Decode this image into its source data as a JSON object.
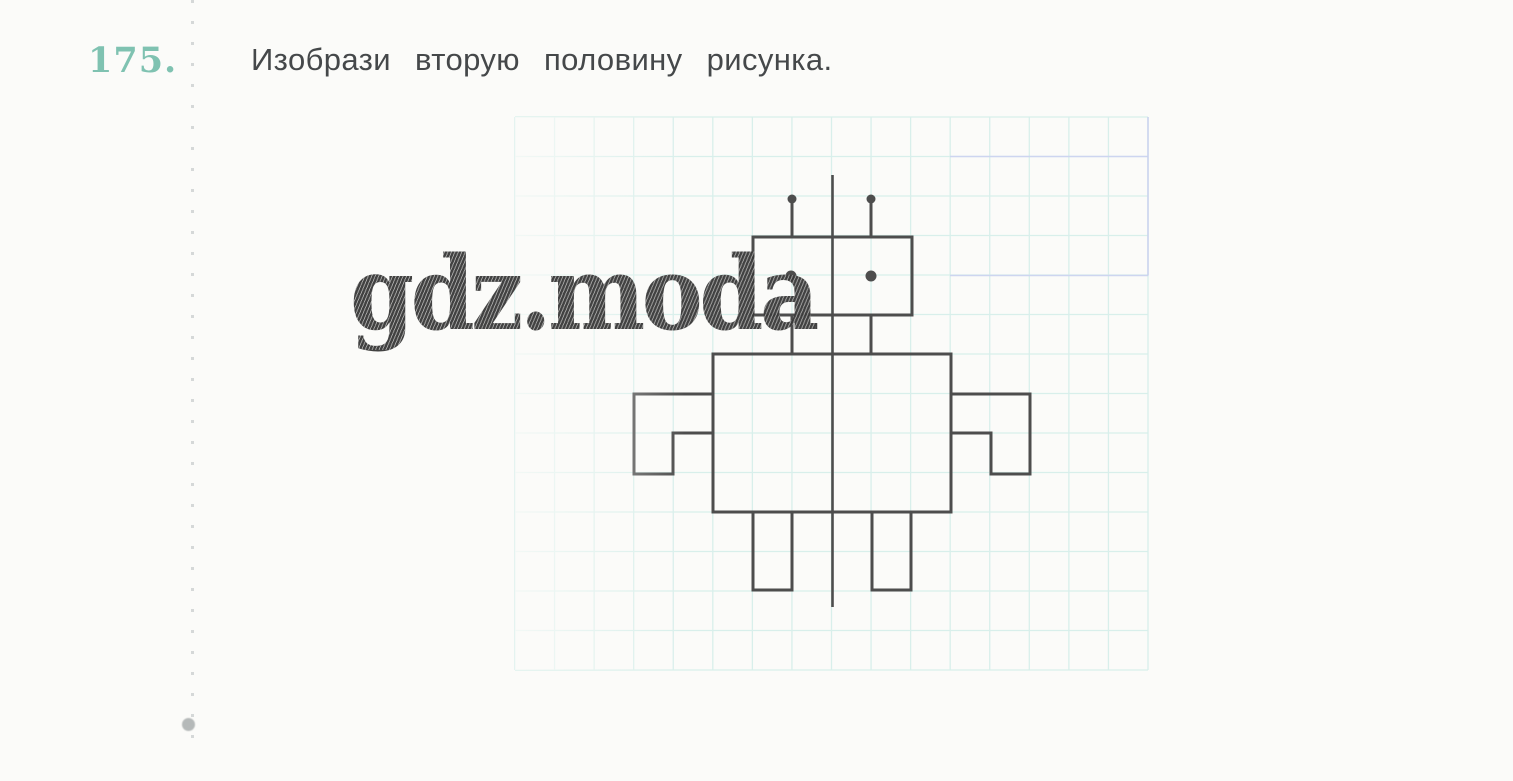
{
  "page": {
    "background": "#fbfbf9"
  },
  "task": {
    "number": "175.",
    "number_color": "#7fc2b1",
    "instruction": "Изобрази  вторую  половину  рисунка.",
    "instruction_color": "#45484a"
  },
  "watermark": {
    "text": "gdz.moda",
    "color": "#3a3a3a"
  },
  "margin": {
    "dots_color": "#ced2d2",
    "blob_color": "#b5b9b9"
  },
  "figure": {
    "description": "half of a robot drawn on squared paper, to be mirrored across the vertical axis",
    "stroke_color": "#4d4d4d",
    "stroke_width": 3,
    "grid": {
      "x": 515,
      "y": 117,
      "cols": 16,
      "rows": 14,
      "cell_w": 39.5625,
      "cell_h": 39.5,
      "line_color": "#d8efeb",
      "line_width": 1.3
    },
    "accent_lines": [
      {
        "x1": 950,
        "y1": 156.5,
        "x2": 1148,
        "y2": 156.5,
        "color": "#cdd5f0"
      },
      {
        "x1": 950,
        "y1": 275.5,
        "x2": 1148,
        "y2": 275.5,
        "color": "#cdd5f0"
      },
      {
        "x1": 1148,
        "y1": 117,
        "x2": 1148,
        "y2": 275.5,
        "color": "#c9d2ee"
      }
    ],
    "axis": {
      "name": "symmetry-axis-line",
      "x1": 832.5,
      "y1": 175,
      "x2": 832.5,
      "y2": 607,
      "width": 2.6
    },
    "rects": [
      {
        "name": "robot-head",
        "x": 753,
        "y": 237,
        "w": 159,
        "h": 78
      },
      {
        "name": "robot-body",
        "x": 713,
        "y": 354,
        "w": 238,
        "h": 158
      }
    ],
    "lines": [
      {
        "name": "robot-neck-left",
        "x1": 792,
        "y1": 315,
        "x2": 792,
        "y2": 354
      },
      {
        "name": "robot-neck-right",
        "x1": 871,
        "y1": 315,
        "x2": 871,
        "y2": 354
      },
      {
        "name": "robot-antenna-left",
        "x1": 792,
        "y1": 202,
        "x2": 792,
        "y2": 237
      },
      {
        "name": "robot-antenna-right",
        "x1": 871,
        "y1": 202,
        "x2": 871,
        "y2": 237
      }
    ],
    "polylines": [
      {
        "name": "robot-arm-left",
        "points": "713,394 634,394 634,474 673,474 673,433 713,433"
      },
      {
        "name": "robot-arm-right",
        "points": "951,394 1030,394 1030,474 991,474 991,433 951,433"
      },
      {
        "name": "robot-leg-left",
        "points": "753,512 753,590 792,590 792,512"
      },
      {
        "name": "robot-leg-right",
        "points": "872,512 872,590 911,590 911,512"
      }
    ],
    "dots": [
      {
        "name": "robot-antenna-tip-left",
        "x": 792,
        "y": 199,
        "r": 4.5
      },
      {
        "name": "robot-antenna-tip-right",
        "x": 871,
        "y": 199,
        "r": 4.5
      },
      {
        "name": "robot-eye-left",
        "x": 791,
        "y": 276,
        "r": 5.5
      },
      {
        "name": "robot-eye-right",
        "x": 871,
        "y": 276,
        "r": 5.5
      }
    ]
  }
}
